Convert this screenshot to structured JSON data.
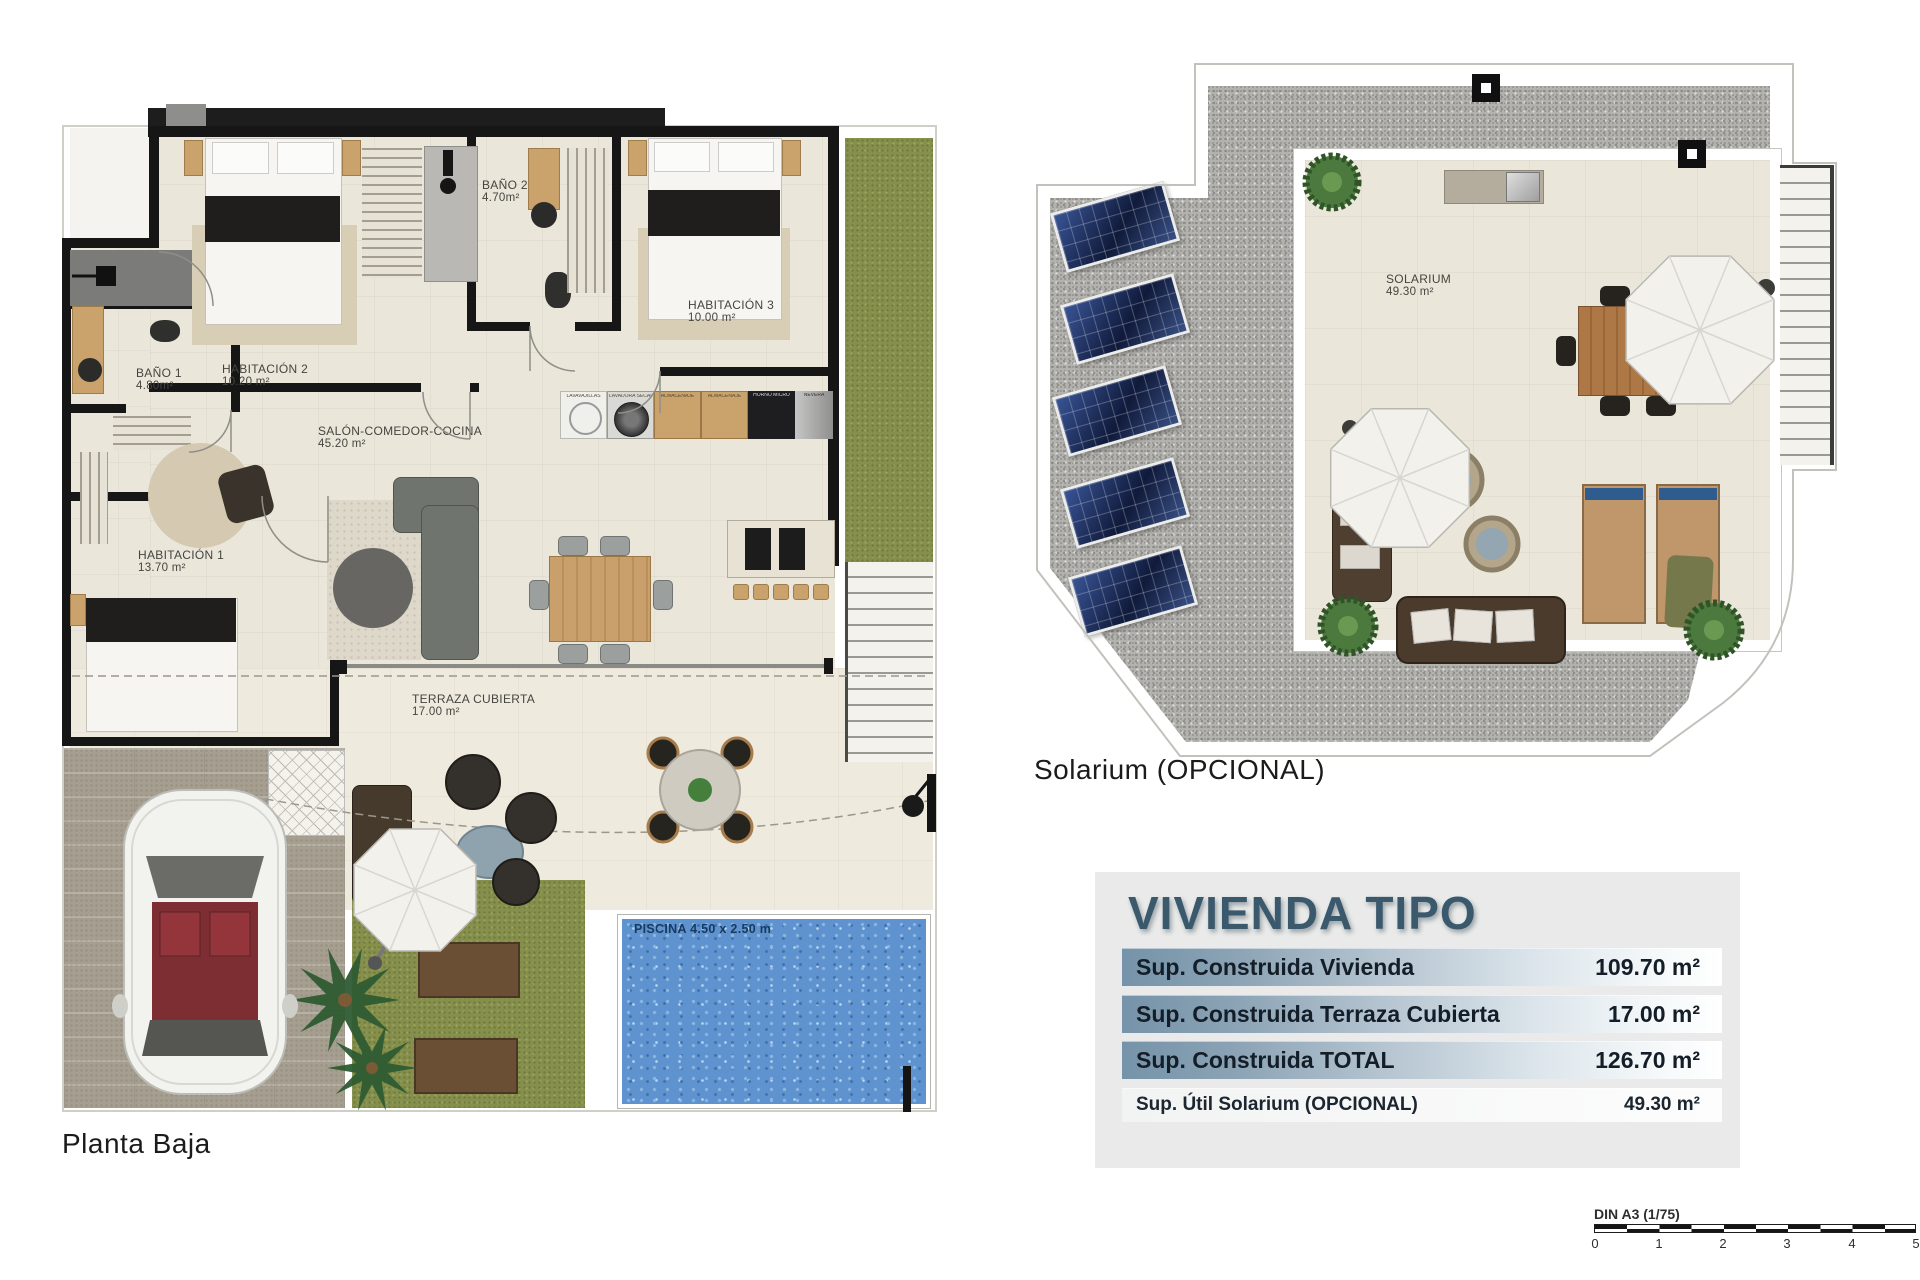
{
  "plans": [
    {
      "caption": "Planta Baja",
      "rooms": [
        {
          "name": "HABITACIÓN 2",
          "area": "10.20 m²"
        },
        {
          "name": "BAÑO 2",
          "area": "4.70m²"
        },
        {
          "name": "HABITACIÓN 3",
          "area": "10.00 m²"
        },
        {
          "name": "BAÑO 1",
          "area": "4.80m²"
        },
        {
          "name": "SALÓN-COMEDOR-COCINA",
          "area": "45.20 m²"
        },
        {
          "name": "HABITACIÓN 1",
          "area": "13.70 m²"
        },
        {
          "name": "TERRAZA CUBIERTA",
          "area": "17.00 m²"
        }
      ],
      "pool_label": "PISCINA 4.50 x 2.50 m",
      "kitchen_modules": [
        "LAVAVAJILLAS",
        "LAVADORA SECADORA",
        "ALMACENAJE",
        "ALMACENAJE",
        "HORNO MICRO",
        "NEVERA"
      ]
    },
    {
      "caption": "Solarium (OPCIONAL)",
      "rooms": [
        {
          "name": "SOLARIUM",
          "area": "49.30 m²"
        }
      ]
    }
  ],
  "summary": {
    "title": "VIVIENDA TIPO",
    "rows": [
      {
        "label": "Sup. Construida Vivienda",
        "value": "109.70 m²"
      },
      {
        "label": "Sup. Construida Terraza Cubierta",
        "value": "17.00 m²"
      },
      {
        "label": "Sup. Construida TOTAL",
        "value": "126.70 m²"
      },
      {
        "label": "Sup. Útil Solarium (OPCIONAL)",
        "value": "49.30 m²"
      }
    ]
  },
  "scale_bar": {
    "label": "DIN A3 (1/75)",
    "ticks": [
      "0",
      "1",
      "2",
      "3",
      "4",
      "5"
    ]
  },
  "colors": {
    "title_blue": "#3b596c",
    "row_gradient_start": "#7593a9",
    "pool_blue": "#5e93cf",
    "grass_green": "#86904c",
    "solar_panel_navy": "#18264f",
    "gravel_grey": "#b3b2ae",
    "wall_black": "#161616",
    "floor_beige": "#ebe6da",
    "wood_tan": "#c9a36b"
  }
}
